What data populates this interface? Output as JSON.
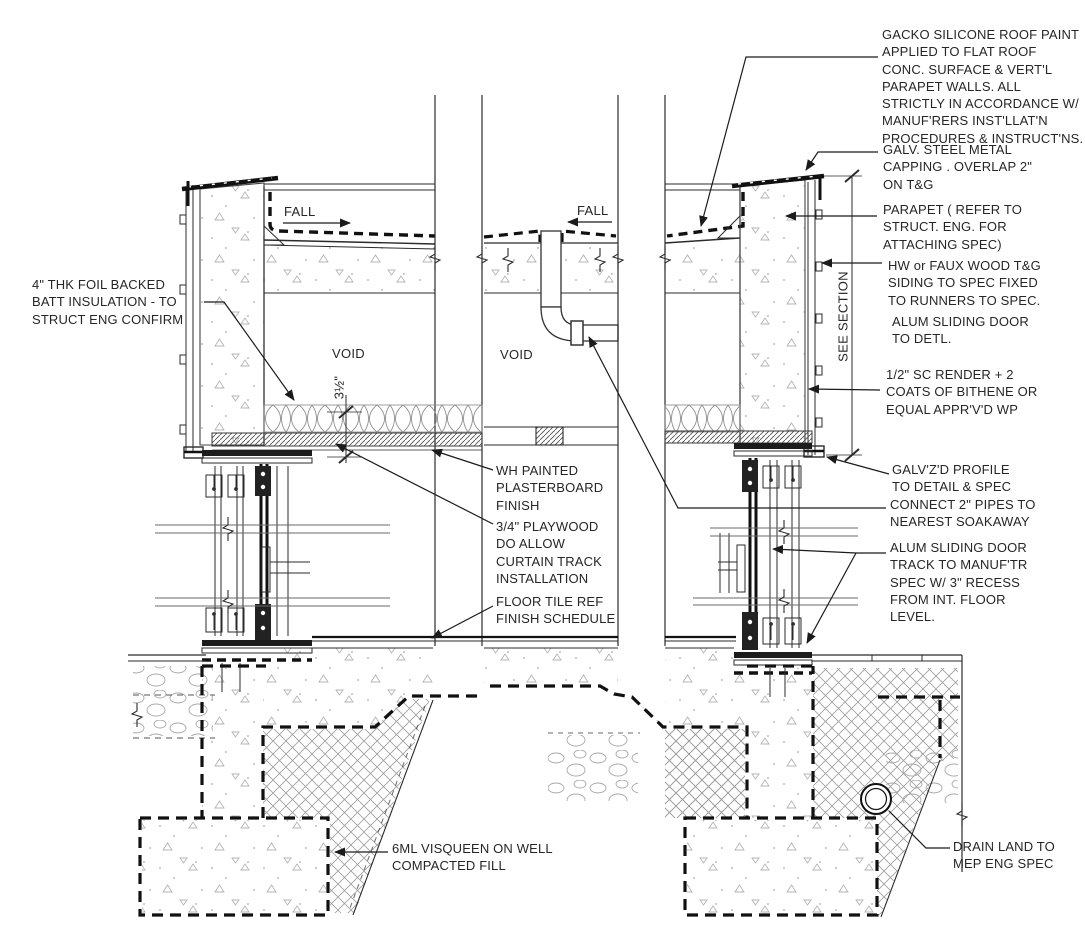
{
  "sheet": {
    "type": "architectural-section-detail",
    "background": "#ffffff",
    "ink_color": "#262626",
    "line_color": "#2b2b2b",
    "membrane_color": "#111111"
  },
  "callouts": {
    "roof_paint": "GACKO SILICONE ROOF PAINT\nAPPLIED TO FLAT ROOF\nCONC. SURFACE & VERT'L\nPARAPET WALLS. ALL\nSTRICTLY IN ACCORDANCE W/\nMANUF'RERS INST'LLAT'N\nPROCEDURES & INSTRUCT'NS.",
    "capping": "GALV. STEEL METAL\nCAPPING . OVERLAP 2\"\nON T&G",
    "parapet": "PARAPET ( REFER TO\nSTRUCT. ENG. FOR\nATTACHING SPEC)",
    "siding": "HW or FAUX WOOD T&G\nSIDING TO SPEC FIXED\nTO RUNNERS TO SPEC.",
    "sliding_door": "ALUM SLIDING DOOR\nTO DETL.",
    "render": "1/2\" SC RENDER + 2\nCOATS OF BITHENE OR\nEQUAL APPR'V'D WP",
    "galv_profile": "GALV'Z'D PROFILE\nTO DETAIL & SPEC",
    "pipes": "CONNECT 2\" PIPES TO\nNEAREST SOAKAWAY",
    "door_track": "ALUM SLIDING DOOR\nTRACK TO MANUF'TR\nSPEC W/ 3\" RECESS\nFROM INT. FLOOR\nLEVEL.",
    "drain": "DRAIN LAND TO\nMEP ENG SPEC",
    "insulation": "4\" THK FOIL BACKED\nBATT INSULATION - TO\nSTRUCT ENG CONFIRM",
    "plasterboard": "WH PAINTED\nPLASTERBOARD\nFINISH",
    "plywood": "3/4\" PLAYWOOD\nDO ALLOW\nCURTAIN TRACK\nINSTALLATION",
    "floor_tile": "FLOOR TILE REF\nFINISH SCHEDULE",
    "visqueen": "6ML VISQUEEN ON WELL\nCOMPACTED FILL"
  },
  "drawing_texts": {
    "fall": "FALL",
    "void": "VOID",
    "see_section": "SEE SECTION",
    "insulation_thickness": "3½\""
  }
}
